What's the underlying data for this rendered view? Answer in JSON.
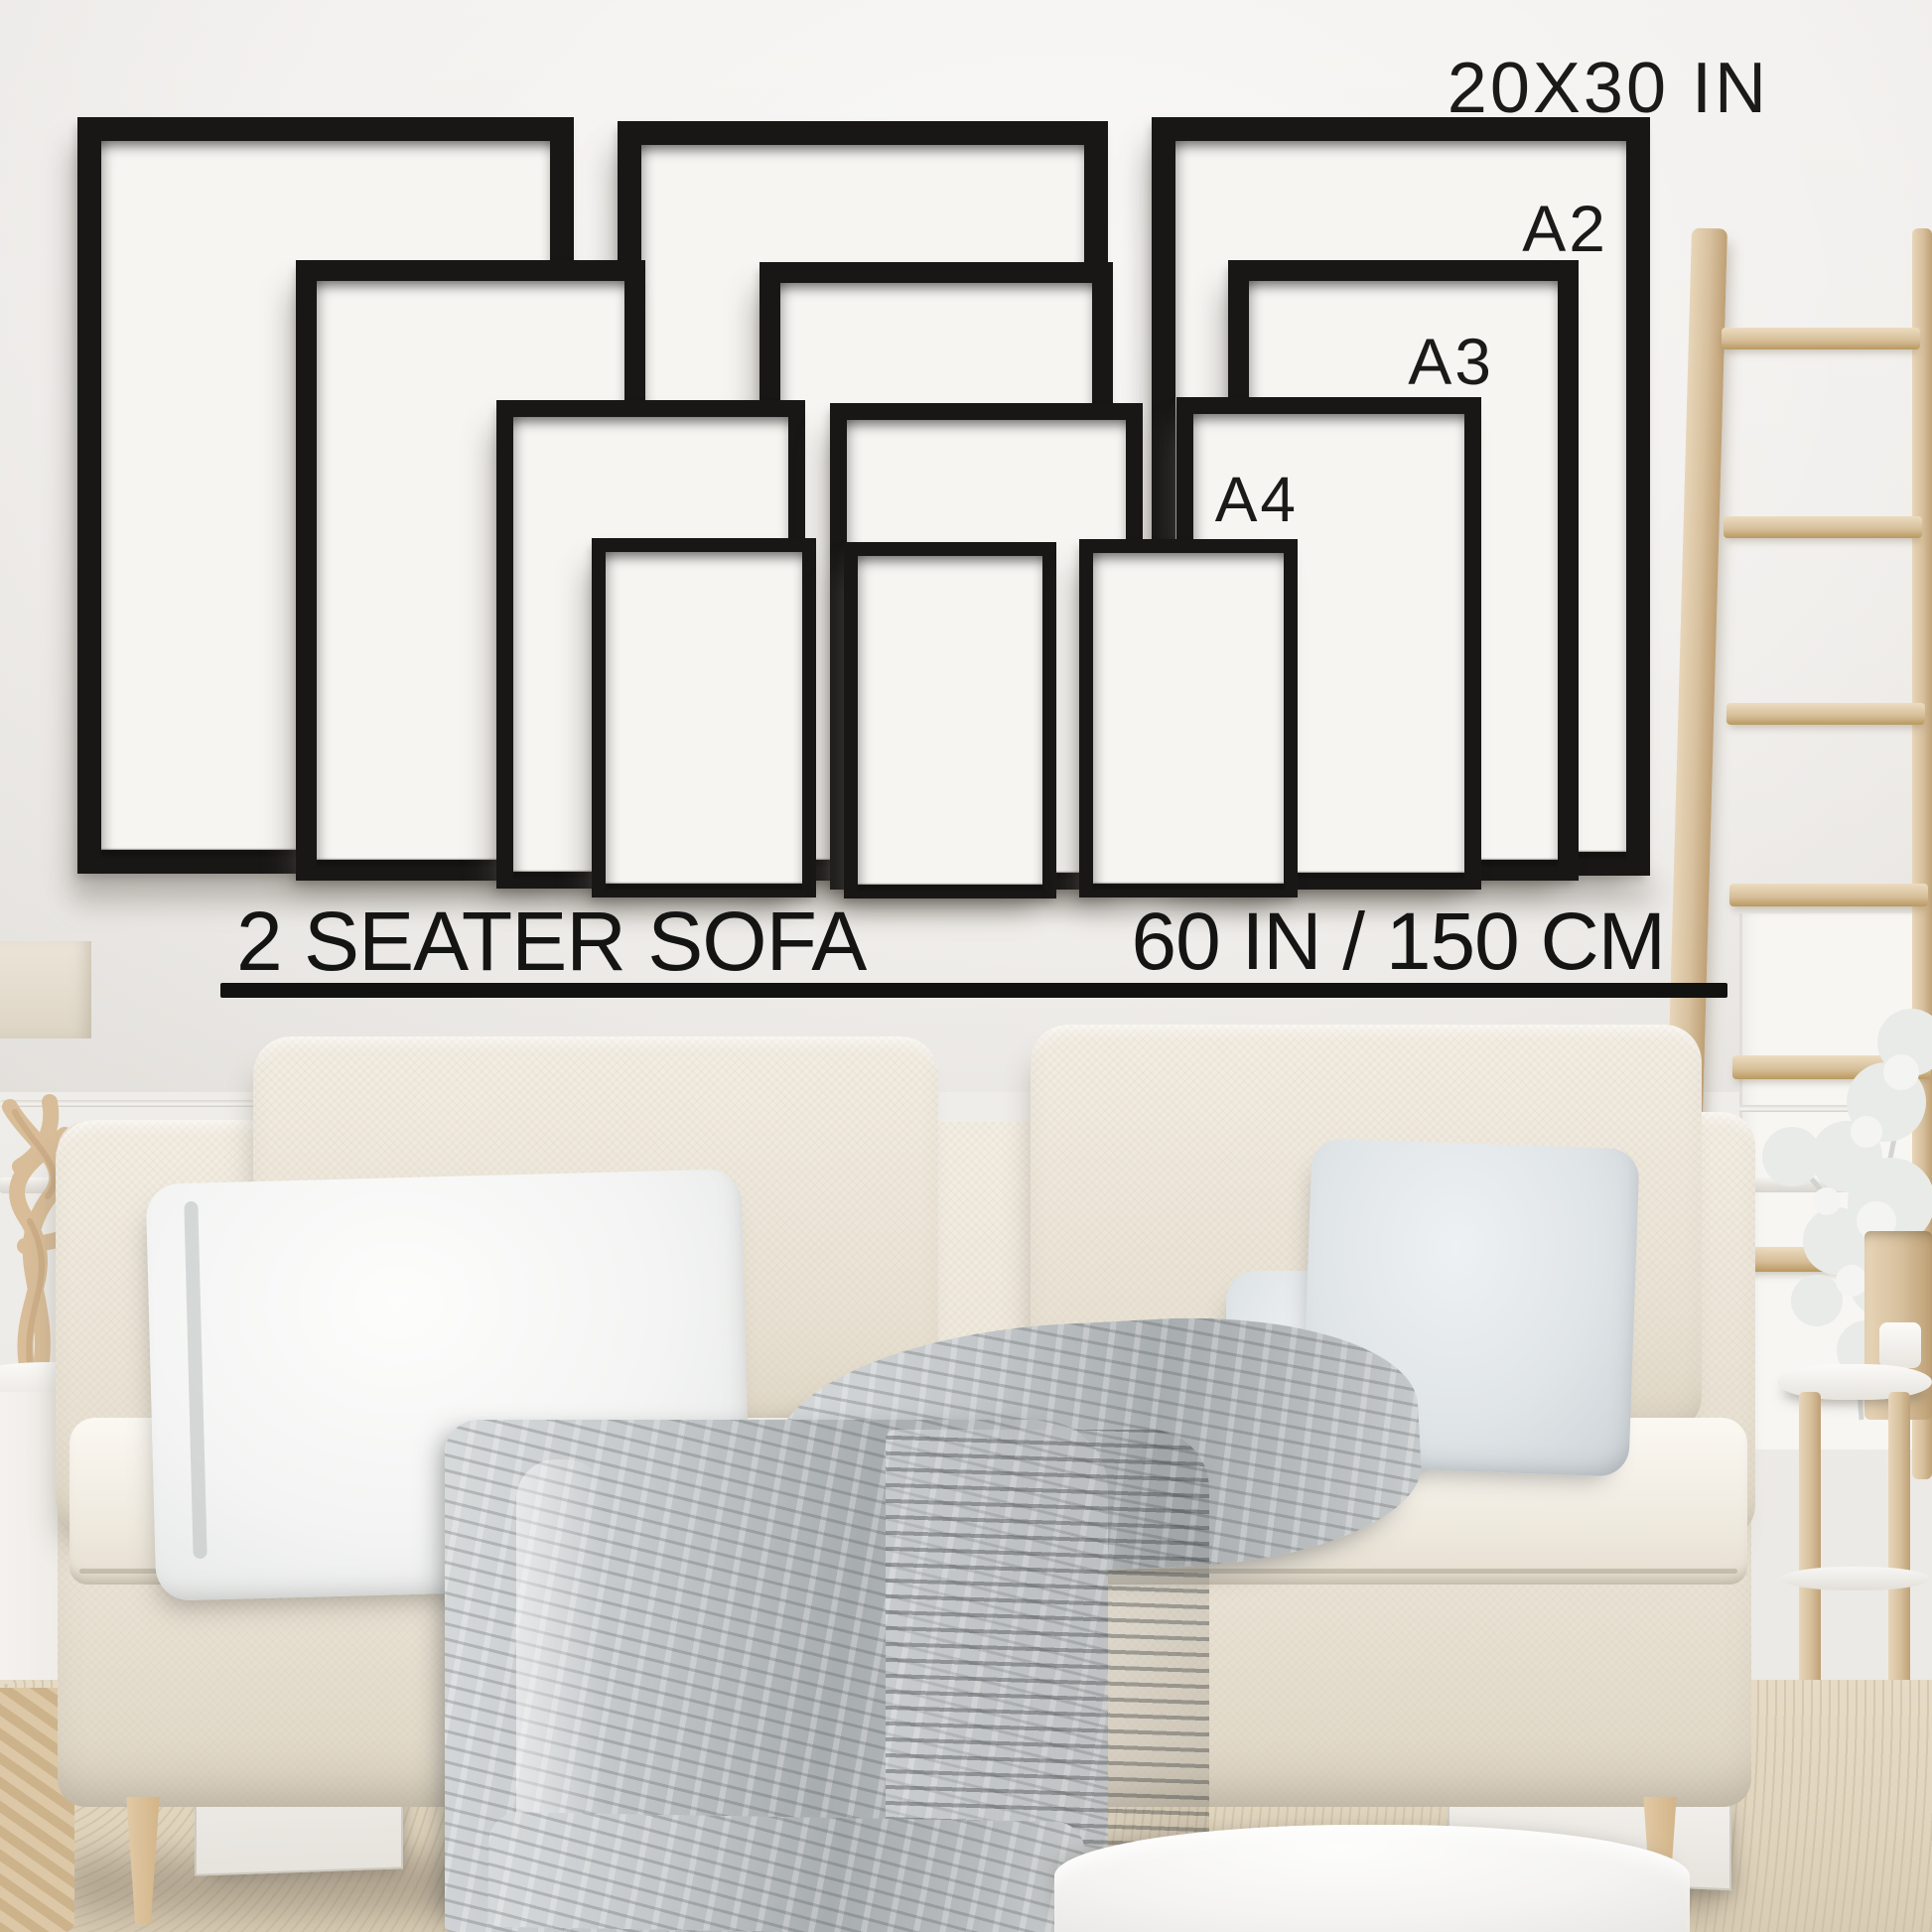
{
  "size_guide": {
    "frame_size_labels": {
      "row1": "20X30 IN",
      "row2": "A2",
      "row3": "A3",
      "row4": "A4"
    },
    "frame_rows": [
      {
        "size": "20X30 IN",
        "frame_count": 3
      },
      {
        "size": "A2",
        "frame_count": 3
      },
      {
        "size": "A3",
        "frame_count": 3
      },
      {
        "size": "A4",
        "frame_count": 3
      }
    ],
    "caption": {
      "sofa_label": "2 SEATER SOFA",
      "sofa_width_label": "60 IN / 150 CM"
    },
    "colors": {
      "frame": "#181716",
      "text": "#141413",
      "wall": "#f1efec",
      "sofa_fabric": "#ece5d8",
      "blanket": "#b4b8bb",
      "carpet": "#e0d4bd",
      "wood": "#d6bf9c"
    }
  }
}
